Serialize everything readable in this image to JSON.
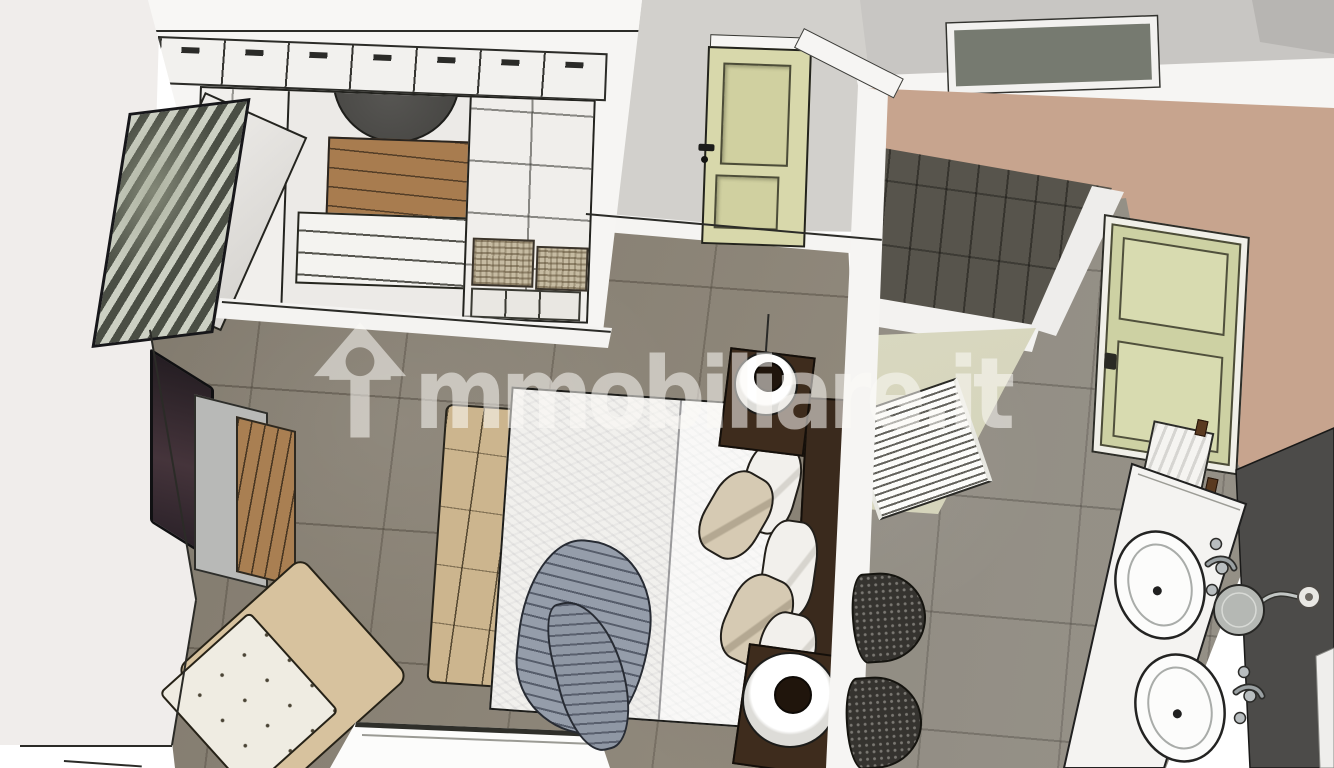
{
  "watermark": {
    "brand": "immobiliare.it",
    "wordmark_after_icon": "mmobiliare.it",
    "color": "rgba(252,250,246,0.55)"
  },
  "palette": {
    "canvas": "#ffffff",
    "bedroom_floor": "#8a8274",
    "bathroom_floor": "#8e897f",
    "wall_gray": "#d2d0cc",
    "wall_white": "#f0edeb",
    "wall_tan": "#c7a48e",
    "wall_sage_green": "#dbdabf",
    "door_pale_green": "#d8d8ab",
    "shower_tile_dark": "#57544c",
    "wood_warm": "#a97f52",
    "dark_walnut": "#3e2c1d",
    "bench_tan": "#ccb58e",
    "duvet_white": "#f1f0ed",
    "throw_gray": "#959daa",
    "pillow_beige": "#d6cab3",
    "pouf_dark": "#35332f",
    "vanity_white": "#f4f3f1",
    "vanity_panel_dark": "#4c4b49"
  },
  "scene": {
    "type": "3d-top-down-interior-render",
    "rooms": [
      {
        "name": "bedroom",
        "items": [
          "wardrobe with cubby doors and open interior",
          "open wardrobe door",
          "round dark mirror",
          "interior wood dresser and drawers",
          "wicker storage boxes",
          "zebra artwork leaning on wall",
          "wall tv",
          "wood-front dresser",
          "beige armchair with white tufted cushion",
          "white desk",
          "double bed with white duvet",
          "gray throw blanket",
          "tufted foot bench",
          "dark headboard",
          "pillows",
          "nightstand with round white lamp (x2)",
          "pale green paneled door"
        ]
      },
      {
        "name": "bathroom",
        "items": [
          "walk-in shower with dark tiles",
          "white ladder towel radiator",
          "dark knitted pouf (x2)",
          "pale green window",
          "towel on rail",
          "double sink vanity",
          "chrome faucets",
          "magnifying mirror on arm",
          "wall lamp plate",
          "dark side panel"
        ]
      }
    ],
    "counts": {
      "wardrobe_cubby_doors": 7,
      "sinks": 2,
      "poufs": 2,
      "pillows": 5,
      "lamps": 2
    }
  }
}
